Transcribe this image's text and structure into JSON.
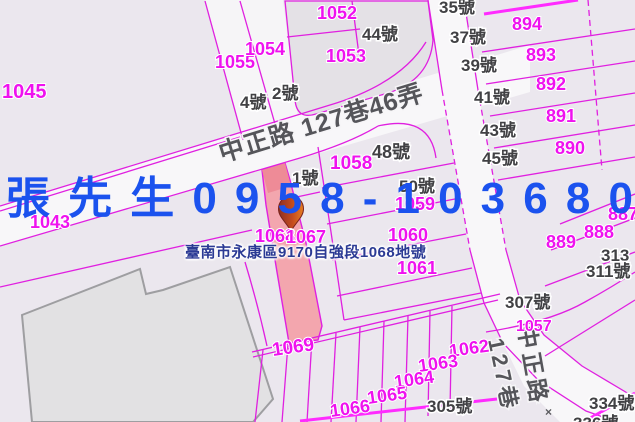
{
  "map": {
    "title": "cadastral-parcel-map",
    "watermark": {
      "text": "張先生0958-103680",
      "chars": [
        "張",
        "先",
        "生",
        "0",
        "9",
        "5",
        "8",
        "-",
        "1",
        "0",
        "3",
        "6",
        "8",
        "0"
      ],
      "color": "#1b52ee"
    },
    "address_label": {
      "text": "臺南市永康區9170自強段1068地號",
      "color": "#2b3a94"
    },
    "roads": {
      "diagonal_road": "中正路 127巷46弄",
      "side_road_col1": "127巷",
      "side_road_col2": "中正路"
    },
    "highlighted_parcel": {
      "id": "1068",
      "fill": "#f3a6ae"
    },
    "parcel_numbers": [
      {
        "id": "1045",
        "x": 2,
        "y": 98,
        "fs": 20
      },
      {
        "id": "1043",
        "x": 30,
        "y": 228
      },
      {
        "id": "1055",
        "x": 215,
        "y": 68
      },
      {
        "id": "1054",
        "x": 245,
        "y": 55
      },
      {
        "id": "1052",
        "x": 317,
        "y": 19
      },
      {
        "id": "1053",
        "x": 326,
        "y": 62
      },
      {
        "id": "894",
        "x": 512,
        "y": 30
      },
      {
        "id": "893",
        "x": 526,
        "y": 61
      },
      {
        "id": "892",
        "x": 536,
        "y": 90
      },
      {
        "id": "891",
        "x": 546,
        "y": 122
      },
      {
        "id": "890",
        "x": 555,
        "y": 154
      },
      {
        "id": "889",
        "x": 546,
        "y": 248
      },
      {
        "id": "888",
        "x": 584,
        "y": 238
      },
      {
        "id": "887",
        "x": 608,
        "y": 220
      },
      {
        "id": "1058",
        "x": 330,
        "y": 169,
        "fs": 19
      },
      {
        "id": "1059",
        "x": 395,
        "y": 210
      },
      {
        "id": "1060",
        "x": 388,
        "y": 241
      },
      {
        "id": "1061",
        "x": 397,
        "y": 274
      },
      {
        "id": "1068",
        "x": 255,
        "y": 242
      },
      {
        "id": "1067",
        "x": 286,
        "y": 243
      },
      {
        "id": "1057",
        "x": 516,
        "y": 331,
        "fs": 16
      },
      {
        "id": "1069",
        "x": 273,
        "y": 356,
        "fs": 19,
        "rot": -8
      },
      {
        "id": "1062",
        "x": 450,
        "y": 357,
        "rot": -8
      },
      {
        "id": "1063",
        "x": 419,
        "y": 372,
        "rot": -8
      },
      {
        "id": "1064",
        "x": 395,
        "y": 388,
        "rot": -8
      },
      {
        "id": "1065",
        "x": 368,
        "y": 404,
        "rot": -8
      },
      {
        "id": "1066",
        "x": 331,
        "y": 417,
        "rot": -8
      }
    ],
    "house_numbers": [
      {
        "id": "44號",
        "x": 362,
        "y": 40
      },
      {
        "id": "2號",
        "x": 272,
        "y": 99
      },
      {
        "id": "4號",
        "x": 240,
        "y": 108
      },
      {
        "id": "35號",
        "x": 439,
        "y": 13
      },
      {
        "id": "37號",
        "x": 450,
        "y": 43
      },
      {
        "id": "39號",
        "x": 461,
        "y": 71
      },
      {
        "id": "41號",
        "x": 474,
        "y": 103
      },
      {
        "id": "43號",
        "x": 480,
        "y": 136
      },
      {
        "id": "45號",
        "x": 482,
        "y": 164
      },
      {
        "id": "48號",
        "x": 372,
        "y": 158,
        "fs": 18
      },
      {
        "id": "50號",
        "x": 399,
        "y": 192
      },
      {
        "id": "1號",
        "x": 292,
        "y": 184
      },
      {
        "id": "313",
        "x": 601,
        "y": 261
      },
      {
        "id": "311號",
        "x": 586,
        "y": 277
      },
      {
        "id": "307號",
        "x": 505,
        "y": 308
      },
      {
        "id": "305號",
        "x": 427,
        "y": 412
      },
      {
        "id": "334號",
        "x": 589,
        "y": 409
      },
      {
        "id": "336號",
        "x": 573,
        "y": 429
      }
    ],
    "survey_marks": [
      {
        "symbol": "×",
        "x": 545,
        "y": 416
      }
    ],
    "colors": {
      "background": "#ebe7ee",
      "road_fill": "#f8f7f9",
      "boundary": "#e020e0",
      "boundary_bright": "#ff2bff",
      "parcel_text": "#ef12ef",
      "house_text": "#414144",
      "road_text": "#55555a",
      "highlight_fill": "#f3a6ae",
      "highlight_top": "#ee8b97",
      "building_fill": "#e2e1e3",
      "building_stroke": "#9e9ea1",
      "watermark": "#1b52ee",
      "address": "#2b3a94"
    }
  }
}
